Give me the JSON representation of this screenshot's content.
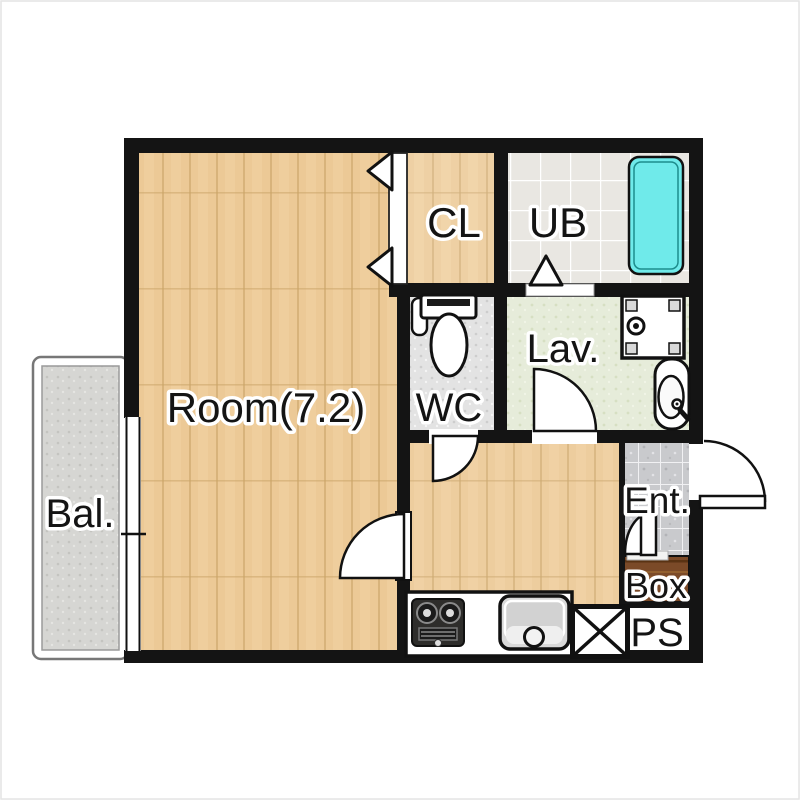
{
  "floorplan": {
    "type": "apartment-floor-plan",
    "rooms": {
      "main": {
        "label": "Room(7.2)"
      },
      "closet": {
        "label": "CL"
      },
      "bath": {
        "label": "UB"
      },
      "toilet": {
        "label": "WC"
      },
      "lavatory": {
        "label": "Lav."
      },
      "balcony": {
        "label": "Bal."
      },
      "entrance": {
        "label": "Ent."
      },
      "shoebox": {
        "label": "Box"
      },
      "pipespace": {
        "label": "PS"
      }
    },
    "fixtures": [
      "bathtub",
      "toilet-bowl",
      "washing-machine-pan",
      "vanity-sink",
      "gas-stove",
      "kitchen-sink",
      "kitchen-counter",
      "front-door-swing",
      "room-door-swing",
      "wc-door-swing",
      "lav-door-swing",
      "ub-folding-door",
      "cl-folding-door",
      "entry-step-door",
      "ps-shaft-marker",
      "balcony-window"
    ],
    "palette": {
      "wall": "#141414",
      "wood": "#ecc996",
      "wood_line": "#d8b37b",
      "ub_tile": "#e9e7e2",
      "ent_tile": "#c9cacd",
      "lav_floor": "#e6ecda",
      "wc_floor": "#e3e3e3",
      "balcony_floor": "#d6d6d3",
      "box_brown": "#7b4a28",
      "bathtub_cyan": "#6feaea",
      "background": "#ffffff"
    }
  }
}
